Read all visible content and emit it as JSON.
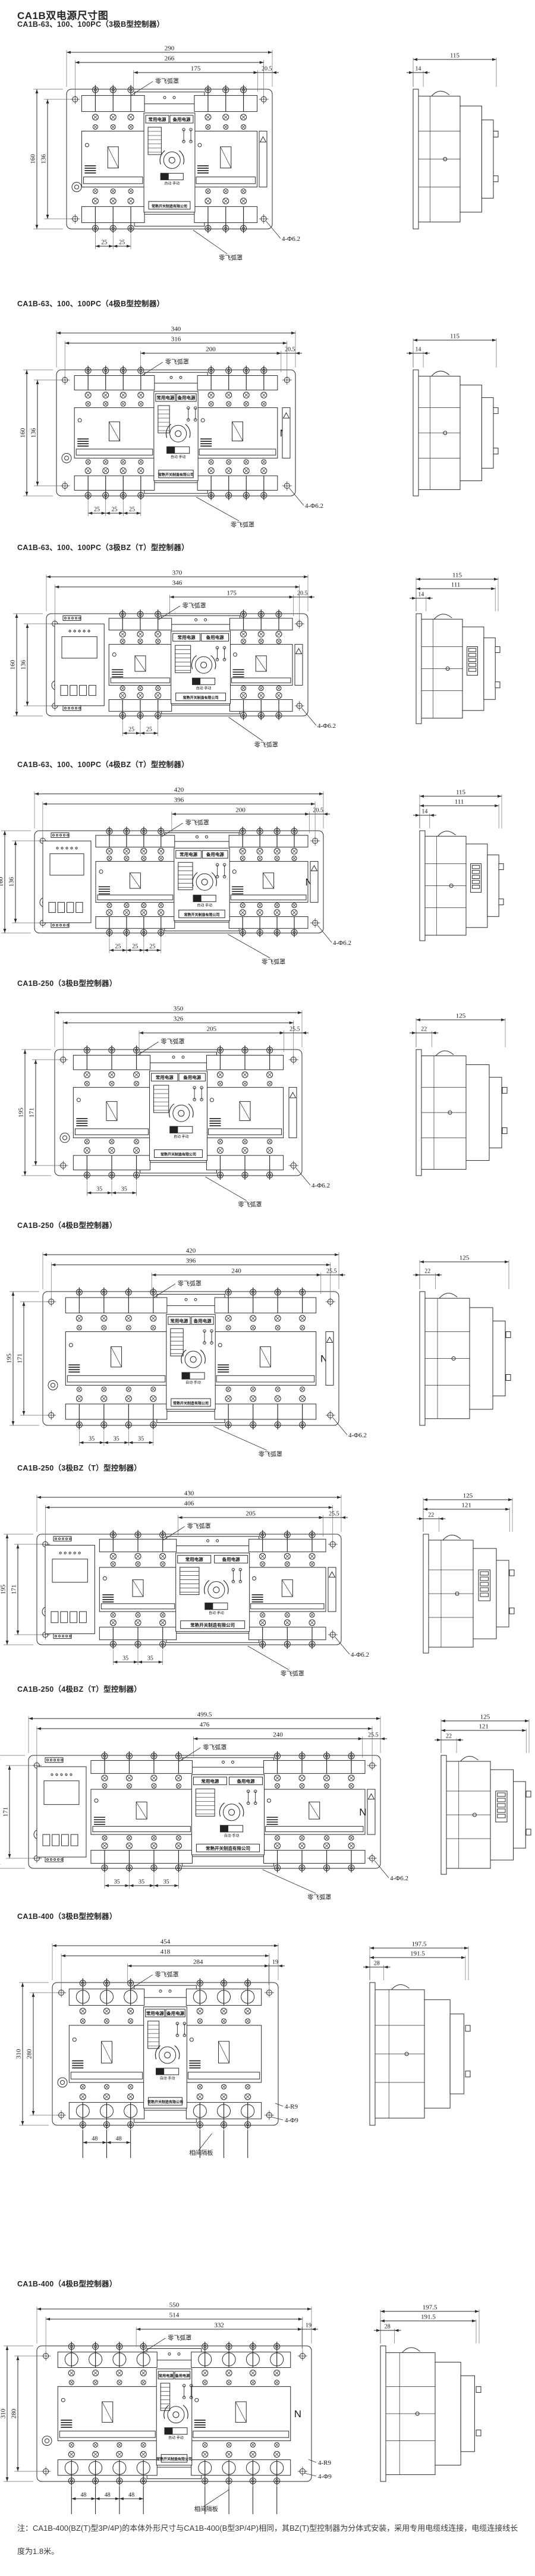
{
  "page": {
    "title": "CA1B双电源尺寸图",
    "note": "注：CA1B-400(BZ(T)型3P/4P)的本体外形尺寸与CA1B-400(B型3P/4P)相同，其BZ(T)型控制器为分体式安装，采用专用电缆线连接，电缆连接线长度为1.8米。"
  },
  "labels": {
    "arc_cover": "零飞弧罩",
    "phase_barrier": "相间隔板",
    "normal_power": "常用电源",
    "reserve_power": "备用电源",
    "auto_manual": "自动 手动",
    "company": "常熟开关制造有限公司",
    "neutral": "N"
  },
  "sections": [
    {
      "heading": "CA1B-63、100、100PC（3极B型控制器）",
      "family": "63-100",
      "poles": 3,
      "bz": false,
      "front": {
        "top_dims": [
          "290",
          "266",
          "175",
          "20.5"
        ],
        "left_dims": [
          "160",
          "136"
        ],
        "pitch_dims": [
          "25",
          "25"
        ],
        "hole_notes": [
          "4-Φ6.2"
        ]
      },
      "side": {
        "dims": [
          "115",
          "14"
        ]
      }
    },
    {
      "heading": "CA1B-63、100、100PC（4极B型控制器）",
      "family": "63-100",
      "poles": 4,
      "bz": false,
      "front": {
        "top_dims": [
          "340",
          "316",
          "200",
          "20.5"
        ],
        "left_dims": [
          "160",
          "136"
        ],
        "pitch_dims": [
          "25",
          "25",
          "25"
        ],
        "hole_notes": [
          "4-Φ6.2"
        ]
      },
      "side": {
        "dims": [
          "115",
          "14"
        ]
      }
    },
    {
      "heading": "CA1B-63、100、100PC（3极BZ（T）型控制器）",
      "family": "63-100",
      "poles": 3,
      "bz": true,
      "front": {
        "top_dims": [
          "370",
          "346",
          "175",
          "20.5"
        ],
        "left_dims": [
          "160",
          "136"
        ],
        "pitch_dims": [
          "25",
          "25"
        ],
        "hole_notes": [
          "4-Φ6.2"
        ]
      },
      "side": {
        "dims": [
          "115",
          "111",
          "14"
        ]
      }
    },
    {
      "heading": "CA1B-63、100、100PC（4极BZ（T）型控制器）",
      "family": "63-100",
      "poles": 4,
      "bz": true,
      "front": {
        "top_dims": [
          "420",
          "396",
          "200",
          "20.5"
        ],
        "left_dims": [
          "160",
          "136"
        ],
        "pitch_dims": [
          "25",
          "25",
          "25"
        ],
        "hole_notes": [
          "4-Φ6.2"
        ]
      },
      "side": {
        "dims": [
          "115",
          "111",
          "14"
        ]
      }
    },
    {
      "heading": "CA1B-250（3极B型控制器）",
      "family": "250",
      "poles": 3,
      "bz": false,
      "front": {
        "top_dims": [
          "350",
          "326",
          "205",
          "25.5"
        ],
        "left_dims": [
          "195",
          "171"
        ],
        "pitch_dims": [
          "35",
          "35"
        ],
        "hole_notes": [
          "4-Φ6.2"
        ]
      },
      "side": {
        "dims": [
          "125",
          "22"
        ]
      }
    },
    {
      "heading": "CA1B-250（4极B型控制器）",
      "family": "250",
      "poles": 4,
      "bz": false,
      "front": {
        "top_dims": [
          "420",
          "396",
          "240",
          "25.5"
        ],
        "left_dims": [
          "195",
          "171"
        ],
        "pitch_dims": [
          "35",
          "35",
          "35"
        ],
        "hole_notes": [
          "4-Φ6.2"
        ]
      },
      "side": {
        "dims": [
          "125",
          "22"
        ]
      }
    },
    {
      "heading": "CA1B-250（3极BZ（T）型控制器）",
      "family": "250",
      "poles": 3,
      "bz": true,
      "front": {
        "top_dims": [
          "430",
          "406",
          "205",
          "25.5"
        ],
        "left_dims": [
          "195",
          "171"
        ],
        "pitch_dims": [
          "35",
          "35"
        ],
        "hole_notes": [
          "4-Φ6.2"
        ]
      },
      "side": {
        "dims": [
          "125",
          "121",
          "22"
        ]
      }
    },
    {
      "heading": "CA1B-250（4极BZ（T）型控制器）",
      "family": "250",
      "poles": 4,
      "bz": true,
      "front": {
        "top_dims": [
          "499.5",
          "476",
          "240",
          "25.5"
        ],
        "left_dims": [
          "195",
          "171"
        ],
        "pitch_dims": [
          "35",
          "35",
          "35"
        ],
        "hole_notes": [
          "4-Φ6.2"
        ]
      },
      "side": {
        "dims": [
          "125",
          "121",
          "22"
        ]
      }
    },
    {
      "heading": "CA1B-400（3极B型控制器）",
      "family": "400",
      "poles": 3,
      "bz": false,
      "front": {
        "top_dims": [
          "454",
          "418",
          "284",
          "19"
        ],
        "left_dims": [
          "310",
          "280"
        ],
        "pitch_dims": [
          "48",
          "48"
        ],
        "hole_notes": [
          "4-R9",
          "4-Φ9"
        ]
      },
      "side": {
        "dims": [
          "197.5",
          "191.5",
          "28"
        ]
      }
    },
    {
      "heading": "CA1B-400（4极B型控制器）",
      "family": "400",
      "poles": 4,
      "bz": false,
      "front": {
        "top_dims": [
          "550",
          "514",
          "332",
          "19"
        ],
        "left_dims": [
          "310",
          "280"
        ],
        "pitch_dims": [
          "48",
          "48",
          "48"
        ],
        "hole_notes": [
          "4-R9",
          "4-Φ9"
        ]
      },
      "side": {
        "dims": [
          "197.5",
          "191.5",
          "28"
        ]
      }
    }
  ]
}
